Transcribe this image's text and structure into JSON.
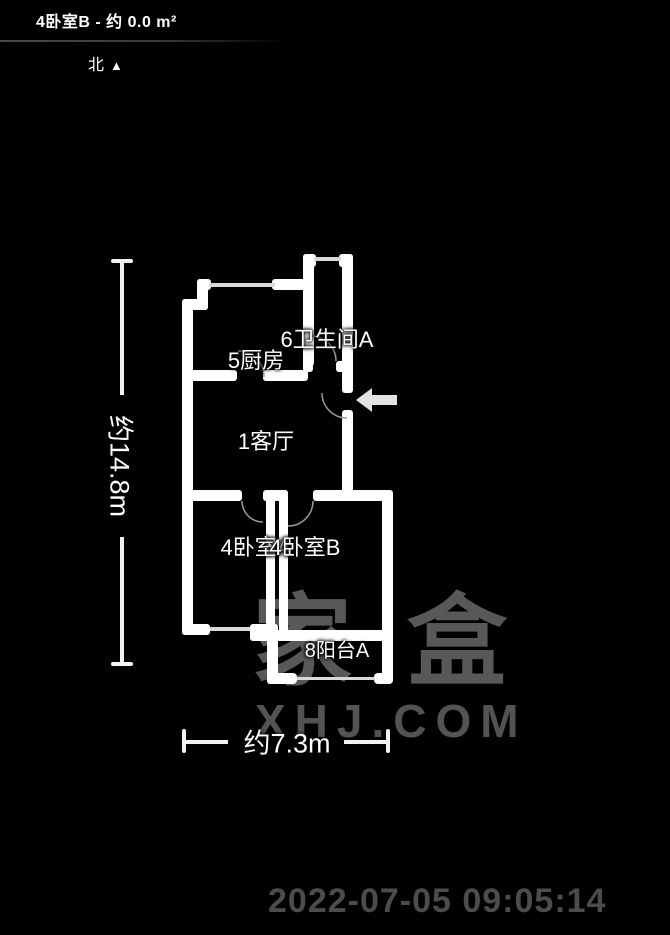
{
  "header": {
    "title": "4卧室B - 约 0.0 m²"
  },
  "compass": {
    "label": "北",
    "arrow": "▲"
  },
  "floorplan": {
    "rooms": [
      {
        "id": "bathroom",
        "label": "6卫生间A"
      },
      {
        "id": "kitchen",
        "label": "5厨房"
      },
      {
        "id": "living-room",
        "label": "1客厅"
      },
      {
        "id": "bedroom-a",
        "label": "4卧室A"
      },
      {
        "id": "bedroom-b",
        "label": "4卧室B"
      },
      {
        "id": "balcony",
        "label": "8阳台A"
      }
    ],
    "dimensions": {
      "height": "约14.8m",
      "width": "约7.3m"
    }
  },
  "watermark": {
    "logo": "家盒",
    "site": "XHJ.COM"
  },
  "timestamp": "2022-07-05 09:05:14",
  "colors": {
    "background": "#000000",
    "wall": "#ffffff",
    "window": "#d9d9d9",
    "door_arc": "#9a9a9a",
    "entrance_arrow": "#e2e2e2",
    "watermark": "#585858",
    "timestamp": "#4c4c4c"
  }
}
